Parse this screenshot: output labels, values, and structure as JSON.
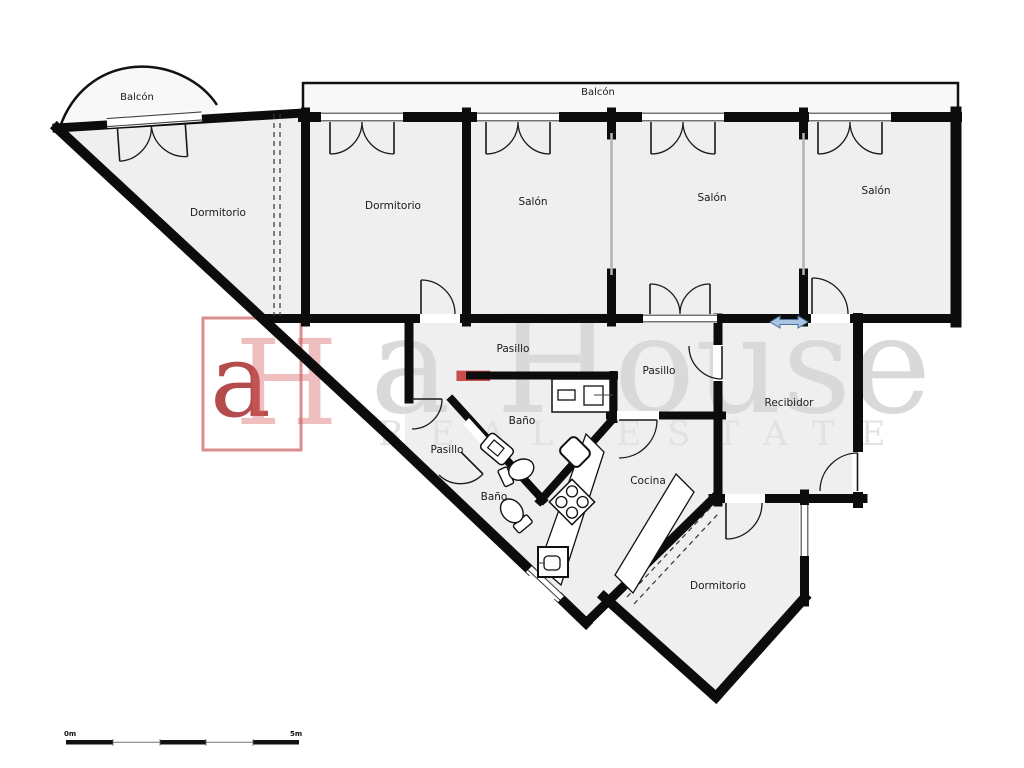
{
  "labels": {
    "balcon_top_left": "Balcón",
    "balcon_top": "Balcón",
    "dormitorio_1": "Dormitorio",
    "dormitorio_2": "Dormitorio",
    "salon_1": "Salón",
    "salon_2": "Salón",
    "salon_3": "Salón",
    "pasillo_1": "Pasillo",
    "pasillo_2": "Pasillo",
    "pasillo_3": "Pasillo",
    "bano_1": "Baño",
    "bano_2": "Baño",
    "cocina": "Cocina",
    "recibidor": "Recibidor",
    "dormitorio_3": "Dormitorio"
  },
  "watermark": {
    "logo_a": "a",
    "logo_h": "H",
    "brand_a": "a",
    "brand_dash": "-",
    "brand_rest": "House",
    "tagline": "REAL ESTATE"
  },
  "scale_bar": {
    "start_label": "0m",
    "end_label": "5m"
  },
  "colors": {
    "wall": "#0c0c0c",
    "floor": "#efefef",
    "balcony_floor": "#f8f8f8",
    "arrow_fill": "#a8c4e0",
    "arrow_stroke": "#4a6fa0",
    "logo_red": "#b32424"
  }
}
